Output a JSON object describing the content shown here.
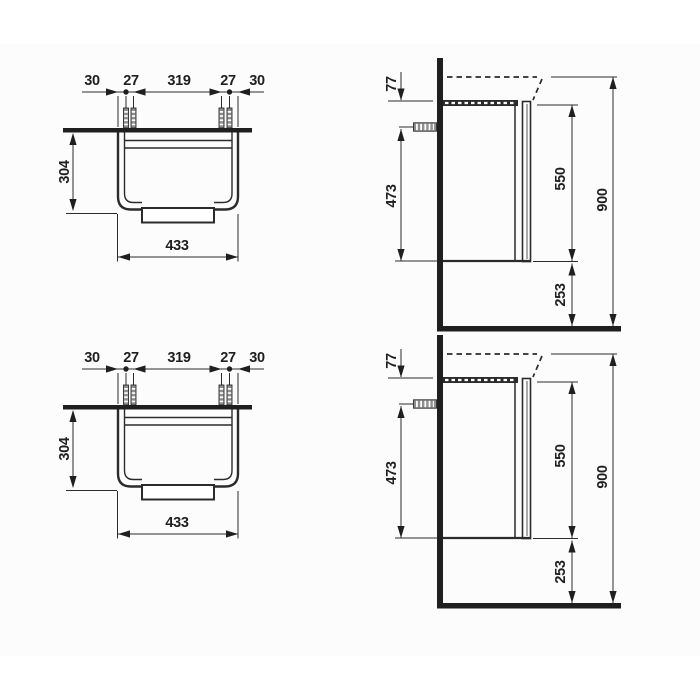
{
  "drawing": {
    "background": "#ffffff",
    "line_color": "#2b2b2b",
    "views": {
      "front": {
        "dimensions": {
          "edge_to_screw_left": "30",
          "screw_pair_left": "27",
          "screw_span": "319",
          "screw_pair_right": "27",
          "edge_to_screw_right": "30",
          "height": "304",
          "width": "433"
        }
      },
      "side": {
        "dimensions": {
          "top_offset": "77",
          "anchor_to_bottom": "473",
          "front_height": "550",
          "overall_height": "900",
          "floor_clearance": "253"
        }
      }
    }
  }
}
